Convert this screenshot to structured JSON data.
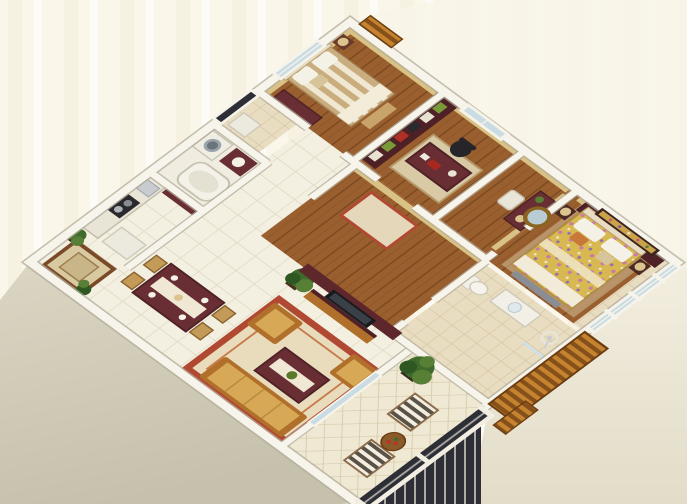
{
  "meta": {
    "title": "3D isometric apartment floor plan rendering",
    "view": "cutaway bird's-eye perspective, no text or labels visible",
    "canvas": {
      "width": 687,
      "height": 504
    }
  },
  "palette": {
    "bg": "#faf6ea",
    "bgStripe": "#f1ecd9",
    "wallTop": "#f7f4ec",
    "wallEdge": "#b3ac99",
    "extFaceLight": "#dbd6c3",
    "extFaceDark": "#c6c1ac",
    "wood": "#9a5f2e",
    "woodDark": "#7b4921",
    "tile": "#f4f0e1",
    "tileLine": "#ddd5bf",
    "tileBeige": "#e9ddc1",
    "tileBeigeLine": "#d2c29f",
    "maroon": "#682e33",
    "maroonDark": "#4e2126",
    "woodTrim": "#b06f2a",
    "sofaGold": "#d7a855",
    "rugRed": "#b04832",
    "rugField": "#ead9b8",
    "bedStripeA": "#c9ad7e",
    "bedStripeB": "#f0e8d2",
    "duvetGold": "#d8b851",
    "floralPink": "#c97ba6",
    "floralPurple": "#8f6cb4",
    "wallpaper": "#d9c285",
    "glass": "#c9dbe3",
    "windowFrame": "#f6f3ea",
    "green1": "#3e6b2c",
    "green2": "#577f36",
    "green3": "#2f5722",
    "slatLight": "#c5832f",
    "slatDark": "#85501a",
    "railDark": "#2e2e36",
    "railLight": "#f2efe2",
    "lampShade": "#dcc48e",
    "pictureGold": "#caa24a",
    "white": "#f4f1e6"
  },
  "rooms": [
    {
      "id": "entry-porch",
      "name": "Entry porch with inlaid rug and potted plants",
      "floor": "white tile"
    },
    {
      "id": "dining-room",
      "name": "Dining area with dark wood table and four chairs",
      "floor": "white tile"
    },
    {
      "id": "living-room",
      "name": "Living room with gold sofa set, coffee table, red-bordered rug and TV wall unit",
      "floor": "white tile"
    },
    {
      "id": "kitchen",
      "name": "Kitchen with counter, cooktop and sink",
      "floor": "white tile"
    },
    {
      "id": "bathroom-1",
      "name": "Bathroom with bathtub, washing machine and vanity",
      "floor": "white tile"
    },
    {
      "id": "utility-balcony",
      "name": "Utility balcony with lattice screen window",
      "floor": "beige tile"
    },
    {
      "id": "bedroom-1",
      "name": "Bedroom with striped bed, wall pictures, dresser and window",
      "floor": "wood"
    },
    {
      "id": "study",
      "name": "Study with bookshelf, writing desk and office chair",
      "floor": "wood"
    },
    {
      "id": "dressing-area",
      "name": "Dressing corridor with round mirror, dressing table and chair",
      "floor": "wood"
    },
    {
      "id": "master-bedroom",
      "name": "Master bedroom with floral bed, headboard panel and flower painting",
      "floor": "wood"
    },
    {
      "id": "master-balcony",
      "name": "Master bedroom balcony with glazed white-framed windows",
      "floor": "beige tile"
    },
    {
      "id": "bathroom-2",
      "name": "En-suite bathroom with toilet, basin vanity and shower",
      "floor": "beige tile"
    },
    {
      "id": "main-balcony",
      "name": "Terrace balcony with striped armchairs, round flower table, potted plant and ornate railing",
      "floor": "diagonal tile"
    },
    {
      "id": "hallway",
      "name": "Hallway with wood floor and runner rug",
      "floor": "wood"
    }
  ],
  "exterior": {
    "side_wall": "tall beige-gray exterior wall face along the lower-left facade",
    "railing": "dark ornate iron balcony railing with white rail",
    "planter": "stacked wooden slat planter boxes at the terrace corner",
    "pergola": "small wooden slat canopy at the top corner",
    "background": "pale cream backdrop with faint vertical streaks"
  }
}
